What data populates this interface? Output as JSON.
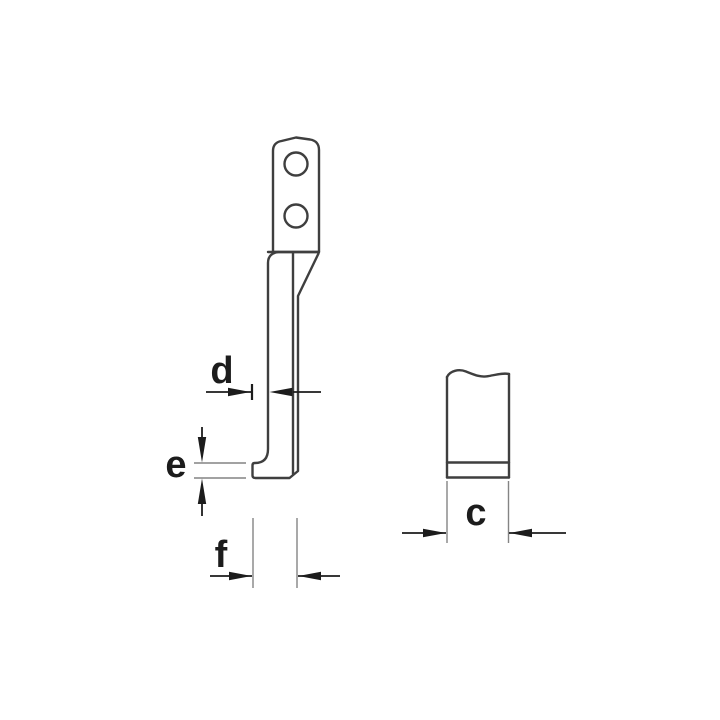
{
  "page": {
    "width": 720,
    "height": 720,
    "background": "#ffffff"
  },
  "diagram": {
    "kind": "technical-line-drawing",
    "subject": "puller-hook-jaw",
    "colors": {
      "outline": "#3f3f3f",
      "dimension": "#1c1c1c",
      "extension": "#848484",
      "background": "#ffffff"
    },
    "views": {
      "side": {
        "name": "hook-side-view",
        "hole_count": 2
      },
      "front": {
        "name": "hook-front-view"
      }
    },
    "dimensions": {
      "d": {
        "label": "d"
      },
      "e": {
        "label": "e"
      },
      "f": {
        "label": "f"
      },
      "c": {
        "label": "c"
      }
    }
  }
}
